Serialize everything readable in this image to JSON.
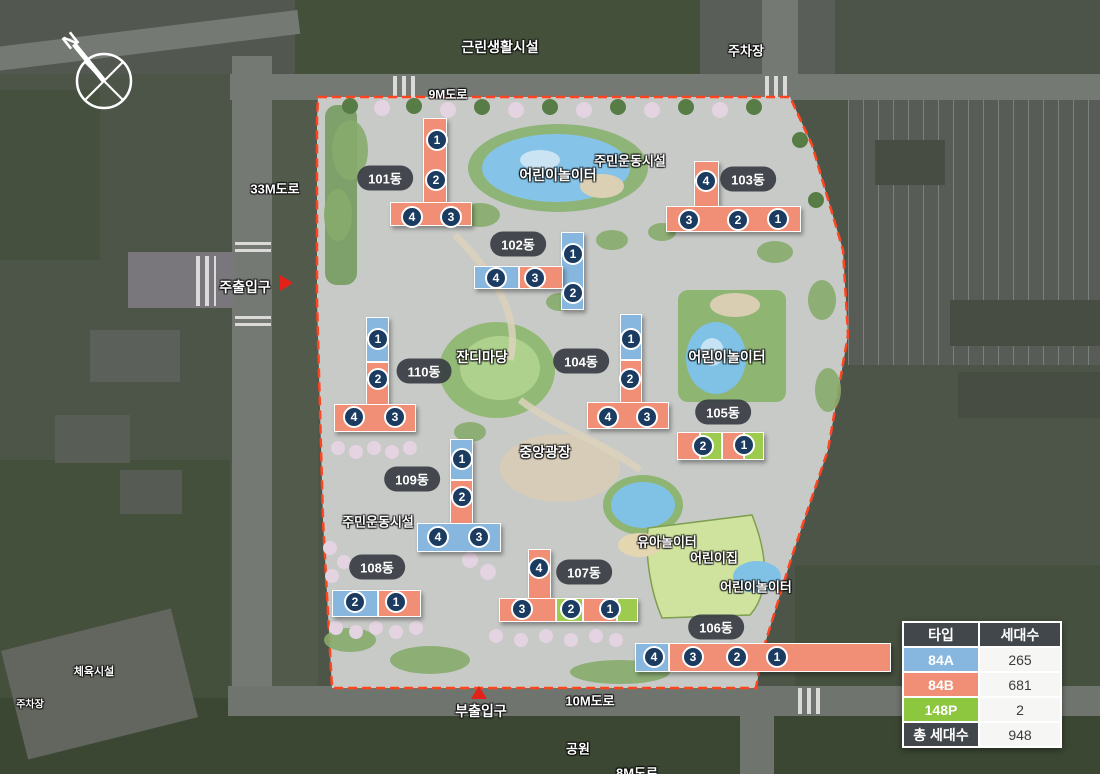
{
  "compass": {
    "north_label": "N"
  },
  "site": {
    "boundary_color": "#FF4420",
    "unit_circle_color": "#1B3B60"
  },
  "context": {
    "neighborhood_facility": "근린생활시설",
    "parking_top": "주차장",
    "road_9m": "9M도로",
    "road_33m": "33M도로",
    "road_10m": "10M도로",
    "road_8m": "8M도로",
    "park": "공원",
    "sports_field": "체육시설",
    "parking_bottom_left": "주차장"
  },
  "entrances": {
    "main": "주출입구",
    "sub": "부출입구"
  },
  "facilities": {
    "playground_top": "어린이놀이터",
    "exercise_top": "주민운동시설",
    "playground_right": "어린이놀이터",
    "lawn": "잔디마당",
    "plaza": "중앙광장",
    "exercise_left": "주민운동시설",
    "toddler_playground": "유아놀이터",
    "daycare": "어린이집",
    "playground_bottom": "어린이놀이터"
  },
  "buildings": [
    {
      "name": "101동",
      "units": [
        {
          "no": "1"
        },
        {
          "no": "2"
        },
        {
          "no": "4"
        },
        {
          "no": "3"
        }
      ]
    },
    {
      "name": "102동",
      "units": [
        {
          "no": "1"
        },
        {
          "no": "2"
        },
        {
          "no": "4"
        },
        {
          "no": "3"
        }
      ]
    },
    {
      "name": "103동",
      "units": [
        {
          "no": "4"
        },
        {
          "no": "3"
        },
        {
          "no": "2"
        },
        {
          "no": "1"
        }
      ]
    },
    {
      "name": "104동",
      "units": [
        {
          "no": "1"
        },
        {
          "no": "2"
        },
        {
          "no": "4"
        },
        {
          "no": "3"
        }
      ]
    },
    {
      "name": "105동",
      "units": [
        {
          "no": "2"
        },
        {
          "no": "1"
        }
      ]
    },
    {
      "name": "106동",
      "units": [
        {
          "no": "4"
        },
        {
          "no": "3"
        },
        {
          "no": "2"
        },
        {
          "no": "1"
        }
      ]
    },
    {
      "name": "107동",
      "units": [
        {
          "no": "4"
        },
        {
          "no": "3"
        },
        {
          "no": "2"
        },
        {
          "no": "1"
        }
      ]
    },
    {
      "name": "108동",
      "units": [
        {
          "no": "2"
        },
        {
          "no": "1"
        }
      ]
    },
    {
      "name": "109동",
      "units": [
        {
          "no": "1"
        },
        {
          "no": "2"
        },
        {
          "no": "4"
        },
        {
          "no": "3"
        }
      ]
    },
    {
      "name": "110동",
      "units": [
        {
          "no": "1"
        },
        {
          "no": "2"
        },
        {
          "no": "4"
        },
        {
          "no": "3"
        }
      ]
    }
  ],
  "legend_table": {
    "headers": [
      "타입",
      "세대수"
    ],
    "rows": [
      {
        "type": "84A",
        "count": "265",
        "color": "#87B6DF"
      },
      {
        "type": "84B",
        "count": "681",
        "color": "#F08F75"
      },
      {
        "type": "148P",
        "count": "2",
        "color": "#8DC63F"
      }
    ],
    "total_label": "총 세대수",
    "total_count": "948"
  }
}
